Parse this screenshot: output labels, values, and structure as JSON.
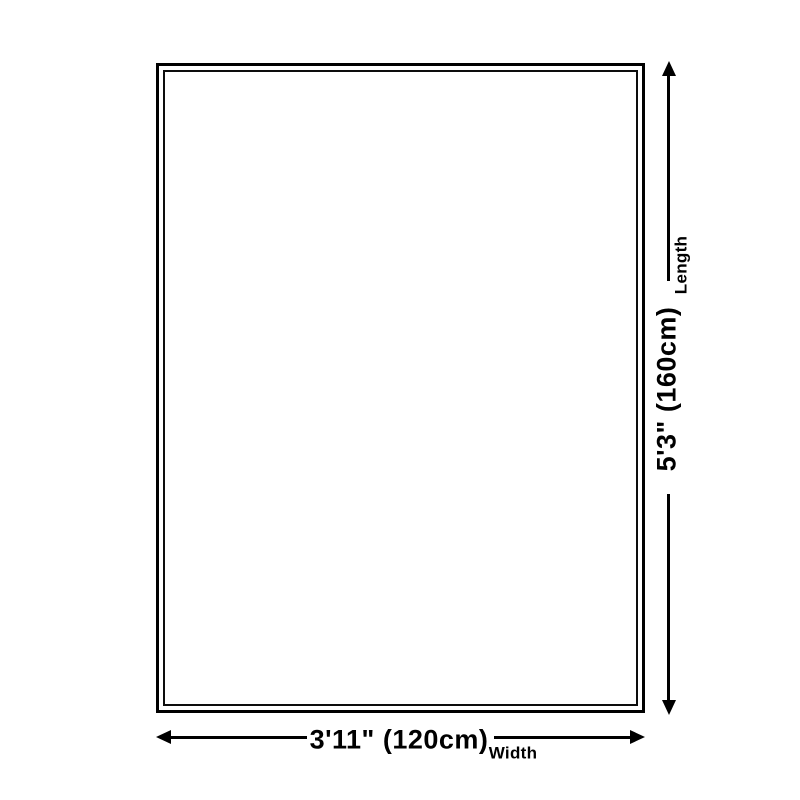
{
  "diagram": {
    "length": {
      "label": "Length",
      "value": "5'3\" (160cm)"
    },
    "width": {
      "label": "Width",
      "value": "3'11\" (120cm)"
    },
    "colors": {
      "line": "#000000",
      "background": "#ffffff"
    }
  }
}
